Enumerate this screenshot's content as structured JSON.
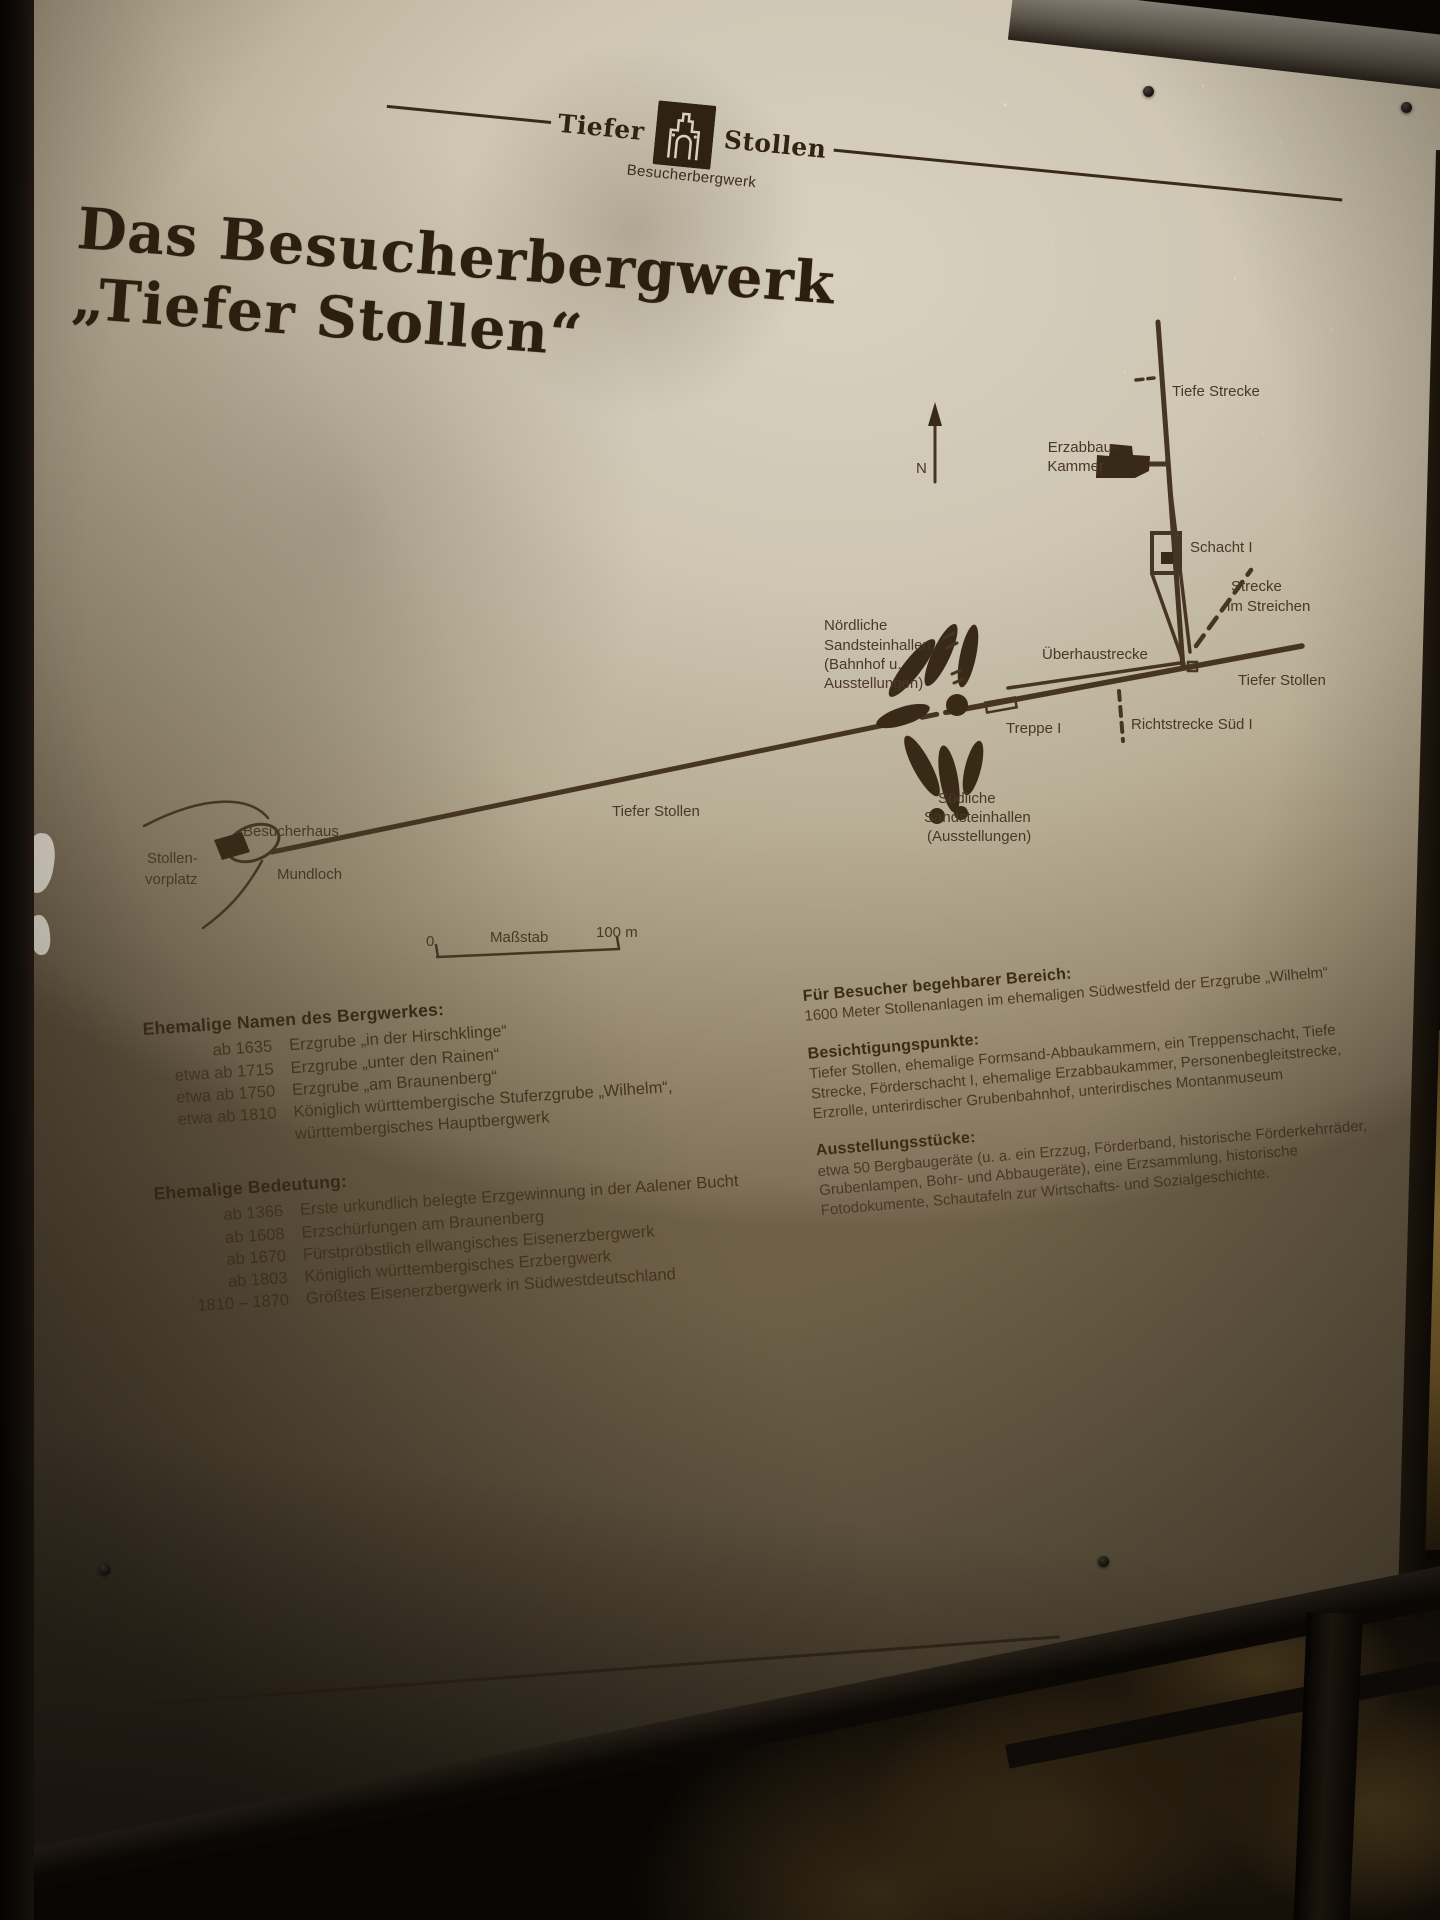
{
  "colors": {
    "sign_panel": "#cfc7b4",
    "ink_dark": "#2c1f10",
    "ink": "#45341f",
    "frame": "#1b140d",
    "rock_gold": "#a8853e"
  },
  "brand": {
    "left": "Tiefer",
    "right": "Stollen",
    "subtitle": "Besucherbergwerk"
  },
  "title": {
    "line1": "Das Besucherbergwerk",
    "line2": "„Tiefer Stollen“"
  },
  "map": {
    "north_label": "N",
    "labels": {
      "tiefe_strecke": "Tiefe Strecke",
      "erzabbau_line1": "Erzabbau-",
      "erzabbau_line2": "Kammer",
      "schacht_i": "Schacht I",
      "strecke_im_streichen_line1": "Strecke",
      "strecke_im_streichen_line2": "im Streichen",
      "ueberhaustrecke": "Überhaustrecke",
      "tiefer_stollen_right": "Tiefer Stollen",
      "richtstrecke_sued": "Richtstrecke Süd I",
      "treppe_i": "Treppe I",
      "noerdliche_line1": "Nördliche",
      "noerdliche_line2": "Sandsteinhallen",
      "noerdliche_line3": "(Bahnhof u.",
      "noerdliche_line4": "Ausstellungen)",
      "suedliche_line1": "Südliche",
      "suedliche_line2": "Sandsteinhallen",
      "suedliche_line3": "(Ausstellungen)",
      "tiefer_stollen_mid": "Tiefer Stollen",
      "besucherhaus": "Besucherhaus",
      "stollenvorplatz_line1": "Stollen-",
      "stollenvorplatz_line2": "vorplatz",
      "mundloch": "Mundloch"
    },
    "scale": {
      "zero": "0",
      "caption": "Maßstab",
      "hundred": "100 m"
    }
  },
  "former_names": {
    "heading": "Ehemalige Namen des Bergwerkes:",
    "rows": [
      {
        "date": "ab 1635",
        "text": "Erzgrube „in der Hirschklinge“"
      },
      {
        "date": "etwa ab 1715",
        "text": "Erzgrube „unter den Rainen“"
      },
      {
        "date": "etwa ab 1750",
        "text": "Erzgrube „am Braunenberg“"
      },
      {
        "date": "etwa ab 1810",
        "text": "Königlich württembergische Stuferzgrube „Wilhelm“,"
      },
      {
        "date": "",
        "text": "württembergisches Hauptbergwerk"
      }
    ]
  },
  "former_importance": {
    "heading": "Ehemalige Bedeutung:",
    "rows": [
      {
        "date": "ab 1366",
        "text": "Erste urkundlich belegte Erzgewinnung in der Aalener Bucht"
      },
      {
        "date": "ab 1608",
        "text": "Erzschürfungen am Braunenberg"
      },
      {
        "date": "ab 1670",
        "text": "Fürstpröbstlich ellwangisches Eisenerzbergwerk"
      },
      {
        "date": "ab 1803",
        "text": "Königlich württembergisches Erzbergwerk"
      },
      {
        "date": "1810 – 1870",
        "text": "Größtes Eisenerzbergwerk in Südwestdeutschland"
      }
    ]
  },
  "visitor_area": {
    "heading": "Für Besucher begehbarer Bereich:",
    "body": "1600 Meter Stollenanlagen im ehemaligen Südwestfeld der Erzgrube „Wilhelm“"
  },
  "sights": {
    "heading": "Besichtigungspunkte:",
    "body": "Tiefer Stollen, ehemalige Formsand-Abbaukammern, ein Treppenschacht, Tiefe Strecke, Förderschacht I, ehemalige Erzabbaukammer, Personenbegleitstrecke, Erzrolle, unterirdischer Grubenbahnhof, unterirdisches Montanmuseum"
  },
  "exhibits": {
    "heading": "Ausstellungsstücke:",
    "body": "etwa 50 Bergbaugeräte (u. a. ein Erzzug, Förderband, historische Förderkehrräder, Grubenlampen, Bohr- und Abbaugeräte), eine Erzsammlung, historische Fotodokumente, Schautafeln zur Wirtschafts- und Sozialgeschichte."
  }
}
